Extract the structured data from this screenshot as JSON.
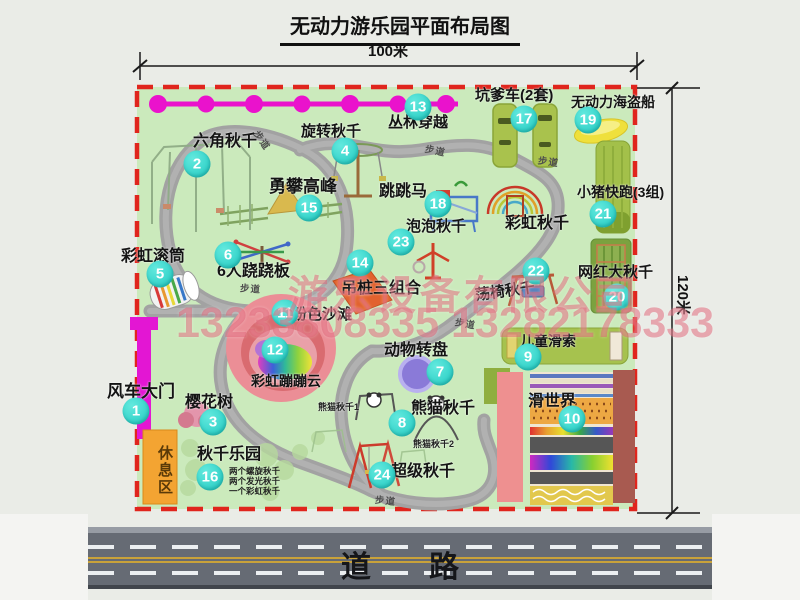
{
  "title": "无动力游乐园平面布局图",
  "dims": {
    "width": "100米",
    "height": "120米"
  },
  "road": {
    "label": "道路"
  },
  "watermark": {
    "company": "游乐设备有限公司",
    "phone": "13233808335 13282178333"
  },
  "labels": {
    "path": "步道",
    "rest_area": "休息区",
    "rainbow_swing": "彩虹秋千"
  },
  "attractions": [
    {
      "num": "1",
      "label": "风车大门"
    },
    {
      "num": "2",
      "label": "六角秋千"
    },
    {
      "num": "3",
      "label": "樱花树"
    },
    {
      "num": "4",
      "label": "旋转秋千"
    },
    {
      "num": "5",
      "label": "彩虹滚筒"
    },
    {
      "num": "6",
      "label": "6人跷跷板"
    },
    {
      "num": "7",
      "label": "动物转盘"
    },
    {
      "num": "8",
      "label": "熊猫秋千",
      "sub1": "熊猫秋千1",
      "sub2": "熊猫秋千2"
    },
    {
      "num": "9",
      "label": "儿童滑索"
    },
    {
      "num": "10",
      "label": "滑世界"
    },
    {
      "num": "11",
      "label": "粉色沙滩"
    },
    {
      "num": "12",
      "label": "彩虹蹦蹦云"
    },
    {
      "num": "13",
      "label": "丛林穿越"
    },
    {
      "num": "14",
      "label": "吊桩三组合"
    },
    {
      "num": "15",
      "label": "勇攀高峰"
    },
    {
      "num": "16",
      "label": "秋千乐园",
      "notes": [
        "两个螺旋秋千",
        "两个发光秋千",
        "一个彩虹秋千"
      ]
    },
    {
      "num": "17",
      "label": "坑爹车(2套)"
    },
    {
      "num": "18",
      "label": "跳跳马"
    },
    {
      "num": "19",
      "label": "无动力海盗船"
    },
    {
      "num": "20",
      "label": "网红大秋千"
    },
    {
      "num": "21",
      "label": "小猪快跑(3组)"
    },
    {
      "num": "22",
      "label": "荡椅秋千"
    },
    {
      "num": "23",
      "label": "泡泡秋千"
    },
    {
      "num": "24",
      "label": "超级秋千"
    }
  ]
}
